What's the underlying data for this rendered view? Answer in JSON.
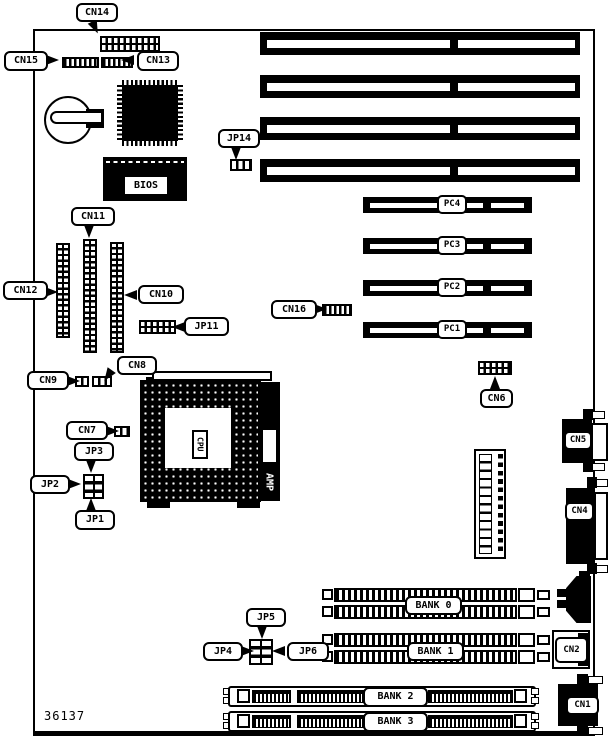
{
  "board": {
    "part_number": "36137",
    "silkscreen": {
      "bios": "BIOS",
      "cpu": "CPU",
      "amp": "AMP"
    }
  },
  "labels": {
    "cn1": "CN1",
    "cn2": "CN2",
    "cn4": "CN4",
    "cn5": "CN5",
    "cn6": "CN6",
    "cn7": "CN7",
    "cn8": "CN8",
    "cn9": "CN9",
    "cn10": "CN10",
    "cn11": "CN11",
    "cn12": "CN12",
    "cn13": "CN13",
    "cn14": "CN14",
    "cn15": "CN15",
    "cn16": "CN16",
    "jp1": "JP1",
    "jp2": "JP2",
    "jp3": "JP3",
    "jp4": "JP4",
    "jp5": "JP5",
    "jp6": "JP6",
    "jp11": "JP11",
    "jp14": "JP14"
  },
  "slots": {
    "pci1": "PC1",
    "pci2": "PC2",
    "pci3": "PC3",
    "pci4": "PC4"
  },
  "memory": {
    "bank0": "BANK 0",
    "bank1": "BANK 1",
    "bank2": "BANK 2",
    "bank3": "BANK 3"
  }
}
